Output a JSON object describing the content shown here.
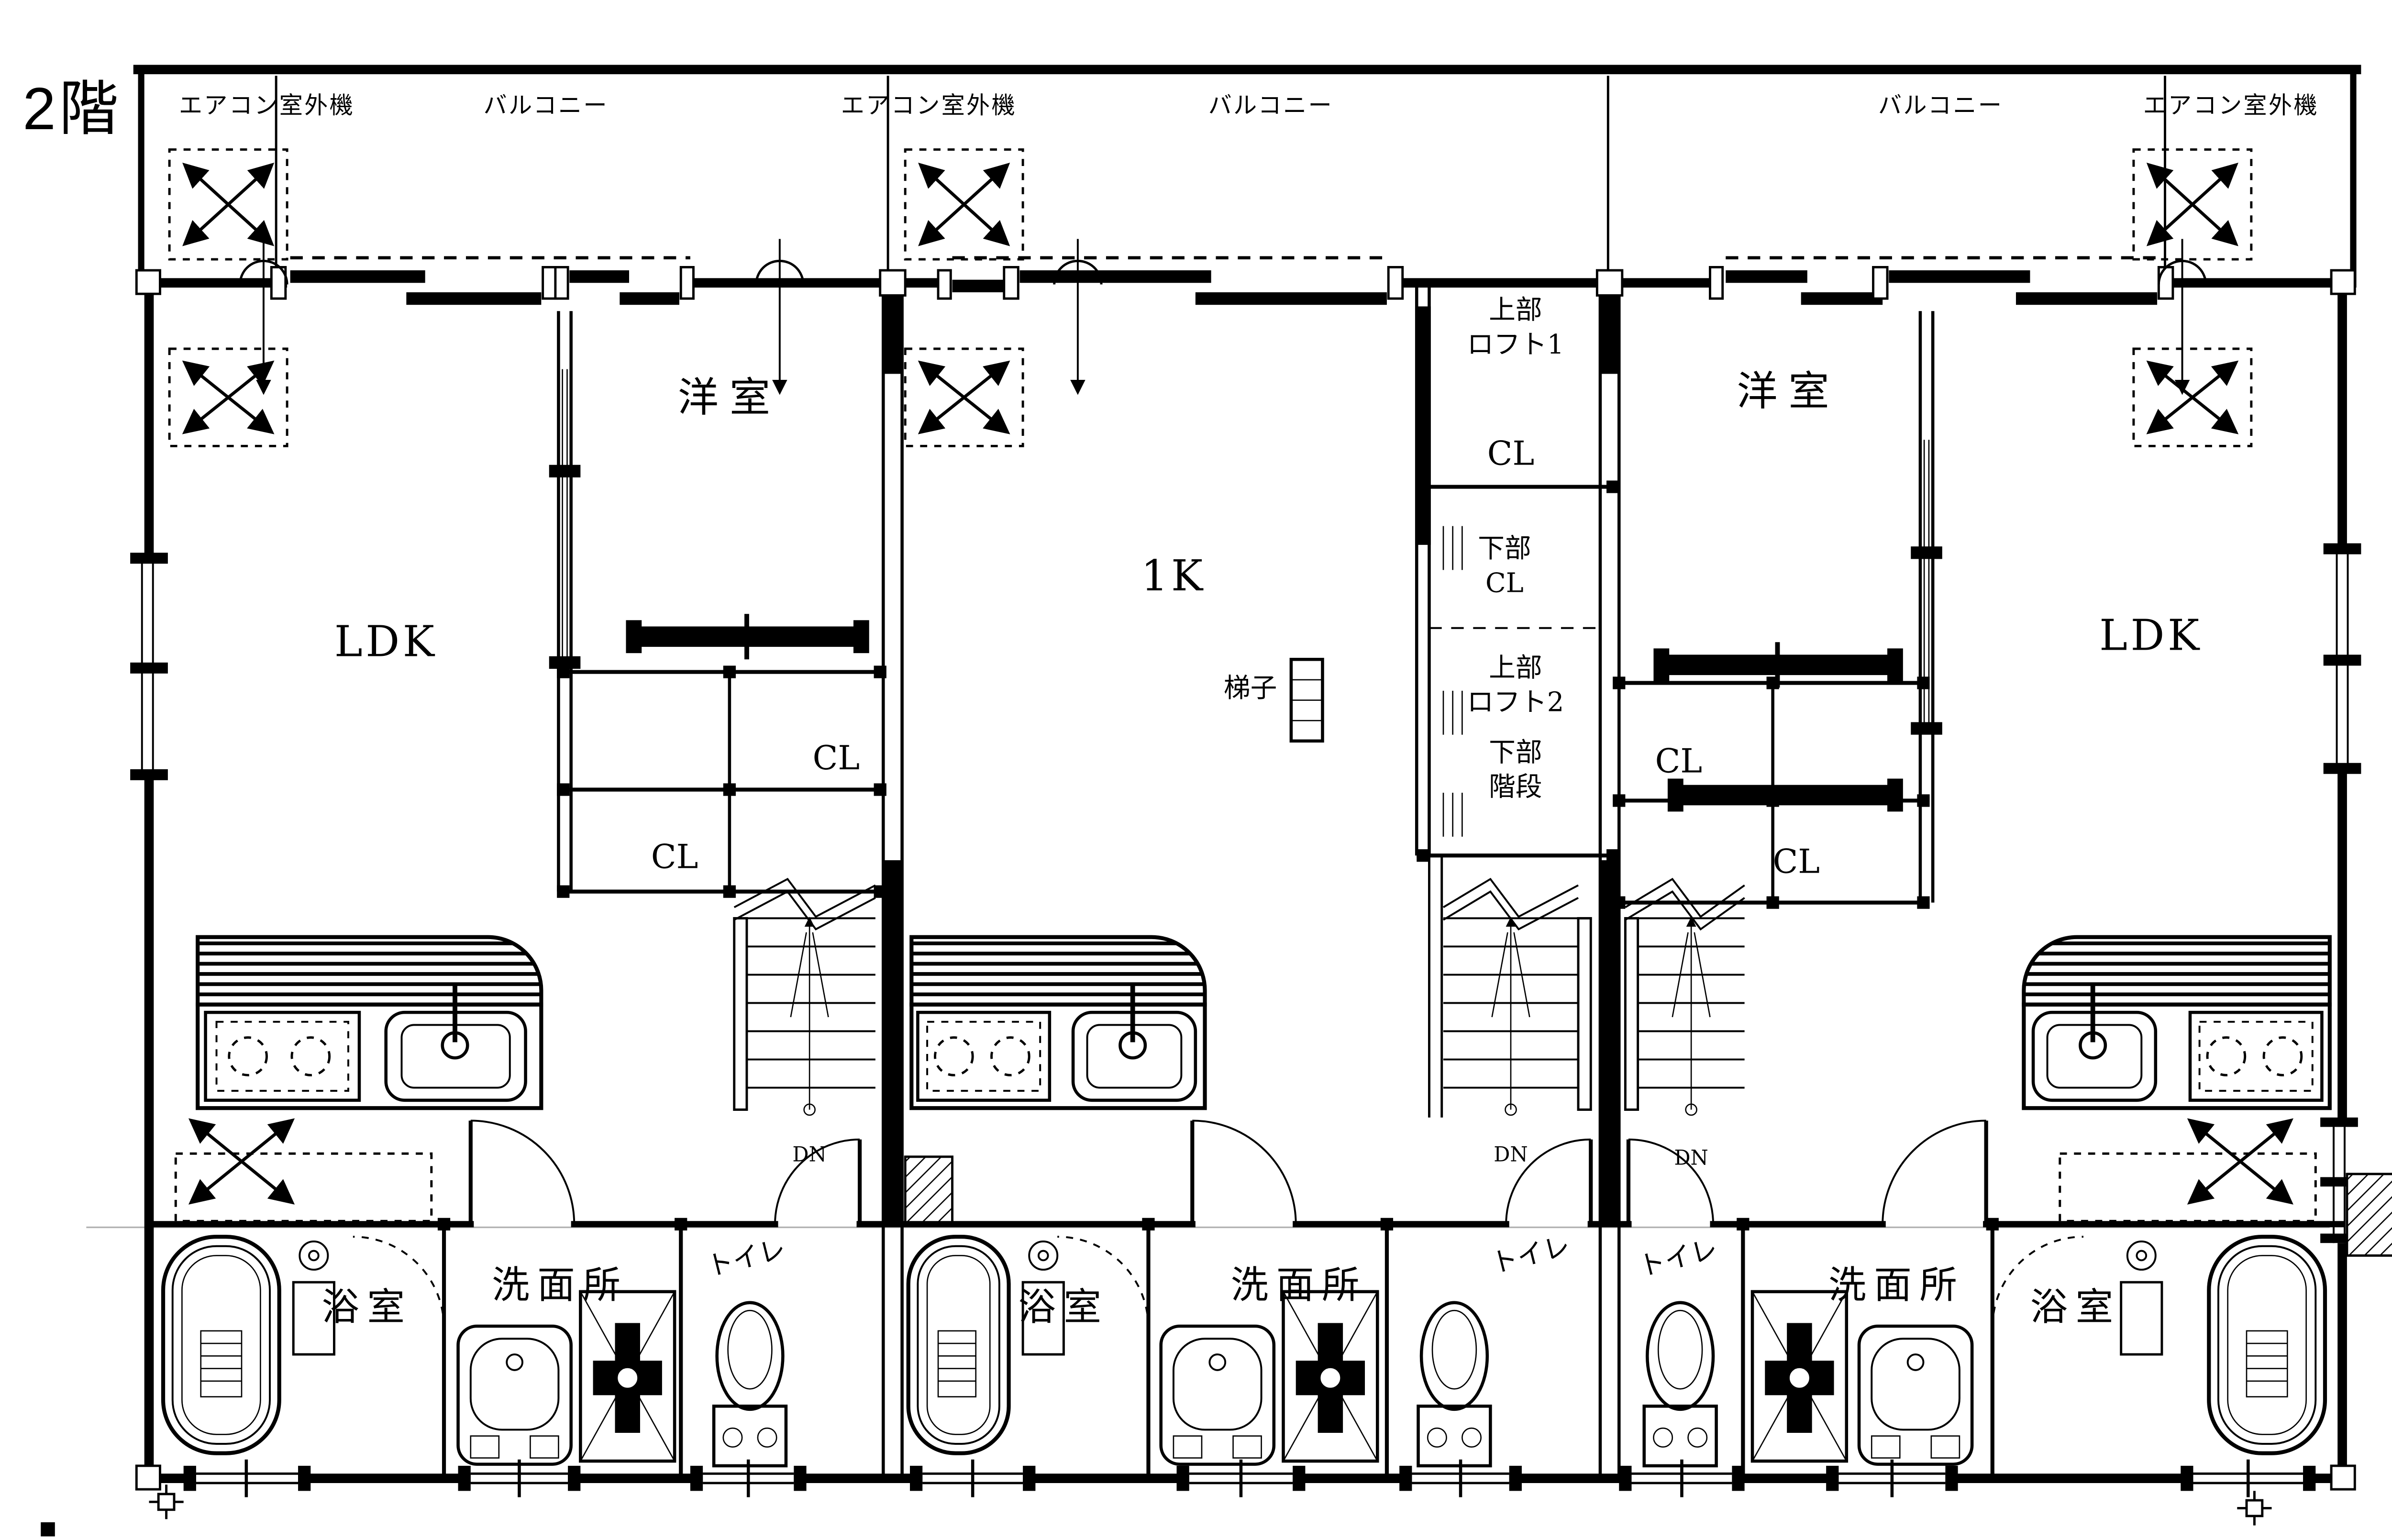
{
  "floor_label": "2階",
  "colors": {
    "accent_red": "#e60012",
    "line": "#000000",
    "background": "#ffffff"
  },
  "top_row": {
    "left_ac": "エアコン室外機",
    "left_balcony": "バルコニー",
    "center_ac": "エアコン室外機",
    "center_balcony": "バルコニー",
    "right_balcony": "バルコニー",
    "right_ac": "エアコン室外機"
  },
  "unit_left": {
    "bedroom": "洋室",
    "living": "LDK",
    "closet_upper": "CL",
    "closet_lower": "CL",
    "stairs_down": "DN",
    "bath": "浴室",
    "washroom": "洗面所",
    "toilet": "トイレ"
  },
  "unit_center": {
    "room": "1K",
    "loft1_line1": "上部",
    "loft1_line2": "ロフト1",
    "closet_top": "CL",
    "under_cl_line1": "下部",
    "under_cl_line2": "CL",
    "loft2_line1": "上部",
    "loft2_line2": "ロフト2",
    "under_stair_line1": "下部",
    "under_stair_line2": "階段",
    "ladder": "梯子",
    "stairs_down": "DN",
    "bath": "浴室",
    "washroom": "洗面所",
    "toilet": "トイレ"
  },
  "unit_right": {
    "bedroom": "洋室",
    "living": "LDK",
    "closet_upper": "CL",
    "closet_lower": "CL",
    "stairs_down": "DN",
    "bath": "浴室",
    "washroom": "洗面所",
    "toilet": "トイレ"
  }
}
